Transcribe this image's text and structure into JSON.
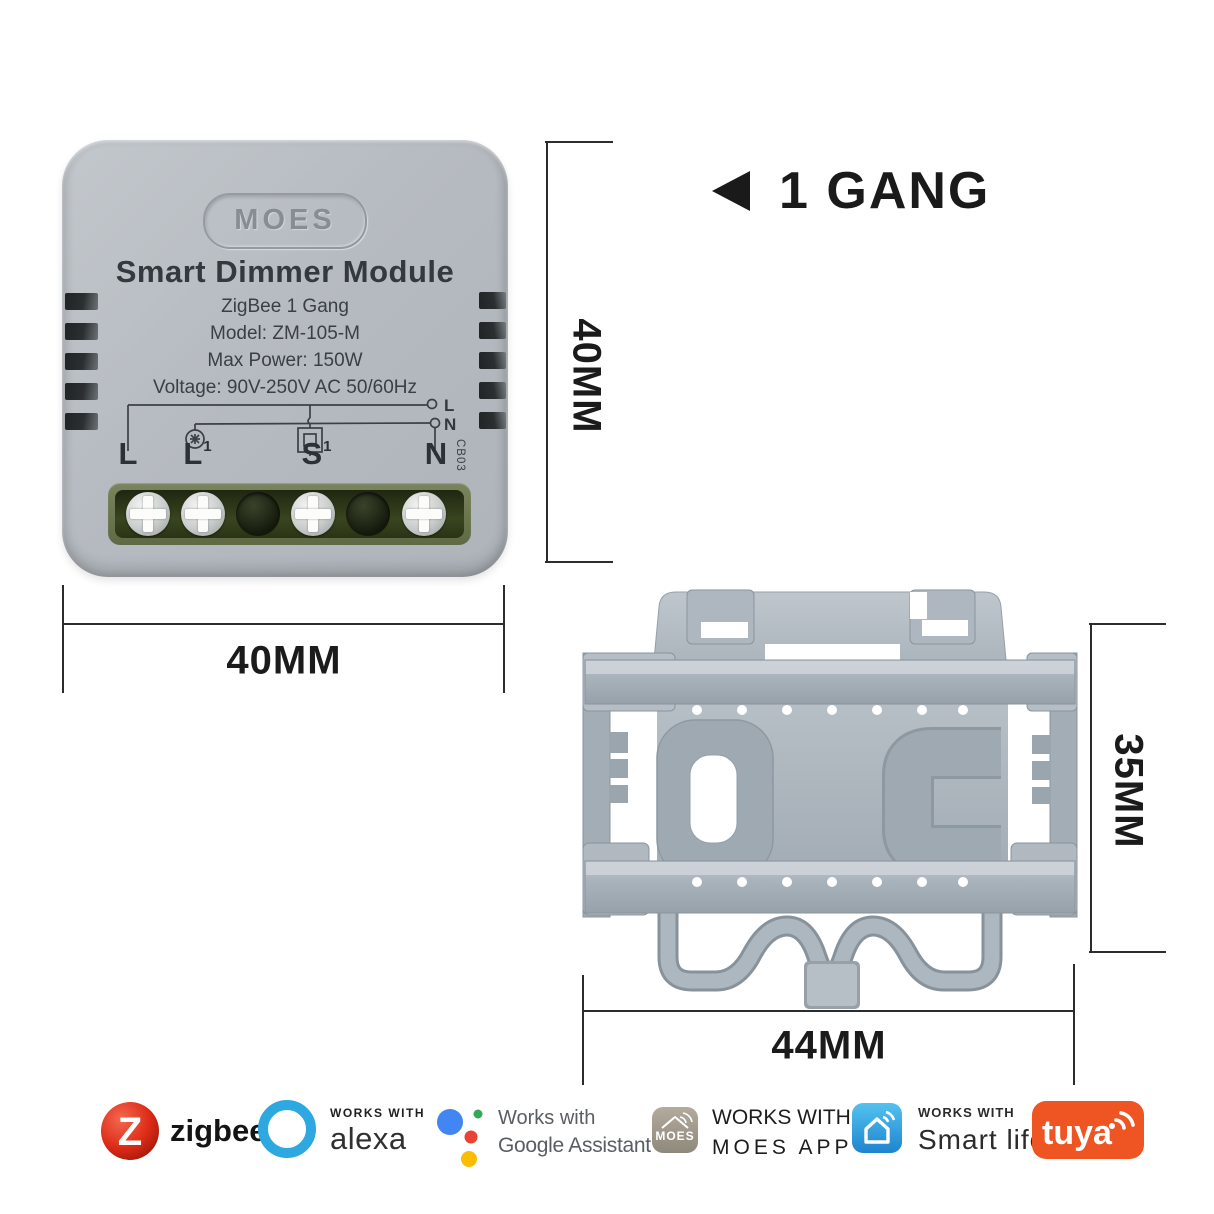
{
  "device": {
    "brand": "MOES",
    "title": "Smart Dimmer Module",
    "line1": "ZigBee 1 Gang",
    "line2": "Model: ZM-105-M",
    "line3": "Max Power: 150W",
    "line4": "Voltage: 90V-250V AC 50/60Hz",
    "terminals": [
      {
        "base": "L",
        "sup": ""
      },
      {
        "base": "L",
        "sup": "1"
      },
      {
        "base": "S",
        "sup": "1"
      },
      {
        "base": "N",
        "sup": ""
      }
    ],
    "diagram": {
      "label_l": "L",
      "label_n": "N"
    },
    "board_code": "CB03"
  },
  "callout": {
    "text": "1 GANG"
  },
  "dimensions": {
    "device_height": "40MM",
    "device_width": "40MM",
    "bracket_height": "35MM",
    "bracket_width": "44MM"
  },
  "badges": {
    "zigbee": {
      "letter": "Z",
      "label": "zigbee",
      "color": "#d8271c"
    },
    "alexa": {
      "works_with": "WORKS WITH",
      "label": "alexa",
      "color": "#2ea8e0"
    },
    "google": {
      "line1": "Works with",
      "line2": "Google Assistant",
      "colors": {
        "blue": "#4285f4",
        "green": "#34a853",
        "red": "#ea4335",
        "yellow": "#fbbc05"
      }
    },
    "moes": {
      "icon_brand": "MOES",
      "line1": "WORKS WITH",
      "line2": "MOES APP",
      "color": "#a39c8d"
    },
    "smartlife": {
      "line1": "WORKS WITH",
      "line2": "Smart life",
      "color": "#2f9ede"
    },
    "tuya": {
      "label": "tuya",
      "color": "#ee5523"
    }
  }
}
